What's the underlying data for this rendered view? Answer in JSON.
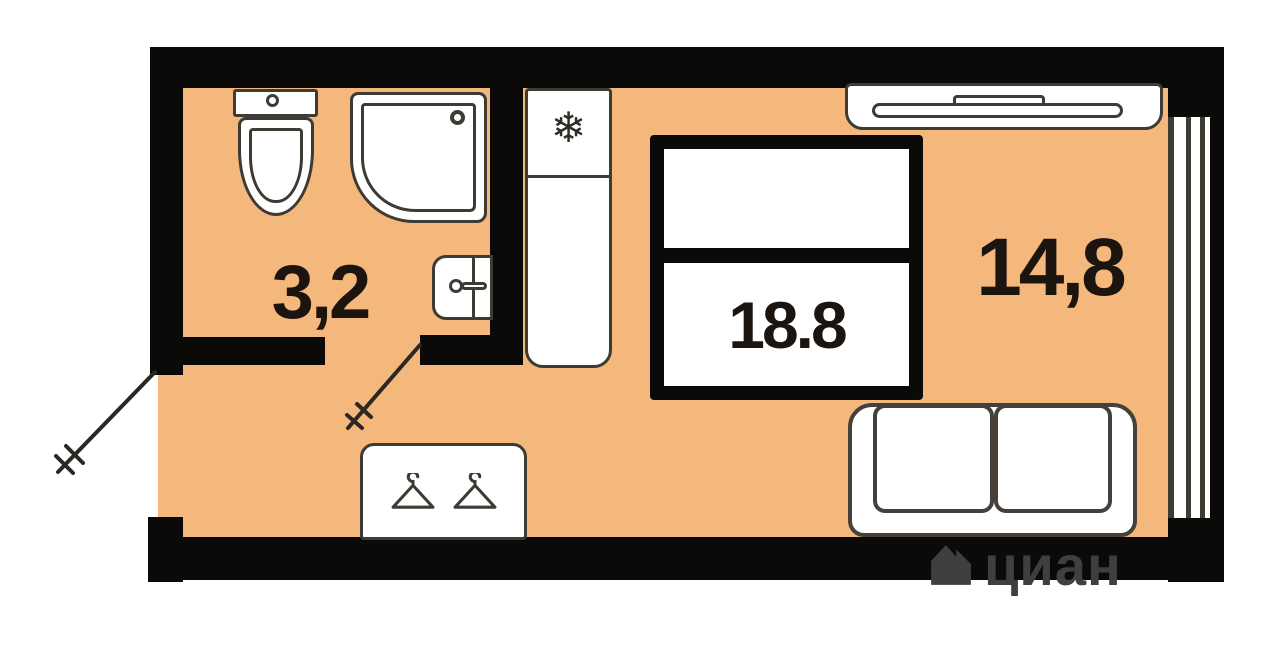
{
  "title": "Studio apartment floor plan",
  "rooms": [
    {
      "id": "bathroom",
      "area_label": "3,2"
    },
    {
      "id": "living_room",
      "area_label": "14,8"
    },
    {
      "id": "total",
      "area_label": "18.8"
    }
  ],
  "watermark": {
    "brand": "циан"
  },
  "icons": {
    "fridge_snowflake": "❄",
    "wardrobe": "hanger-icon",
    "brand": "house-icon"
  },
  "colors": {
    "floor": "#f4b77c",
    "wall": "#0c0a08",
    "outline": "#3e3a34",
    "text": "#1c150f",
    "watermark": "#3f3f3f",
    "background": "#ffffff"
  }
}
